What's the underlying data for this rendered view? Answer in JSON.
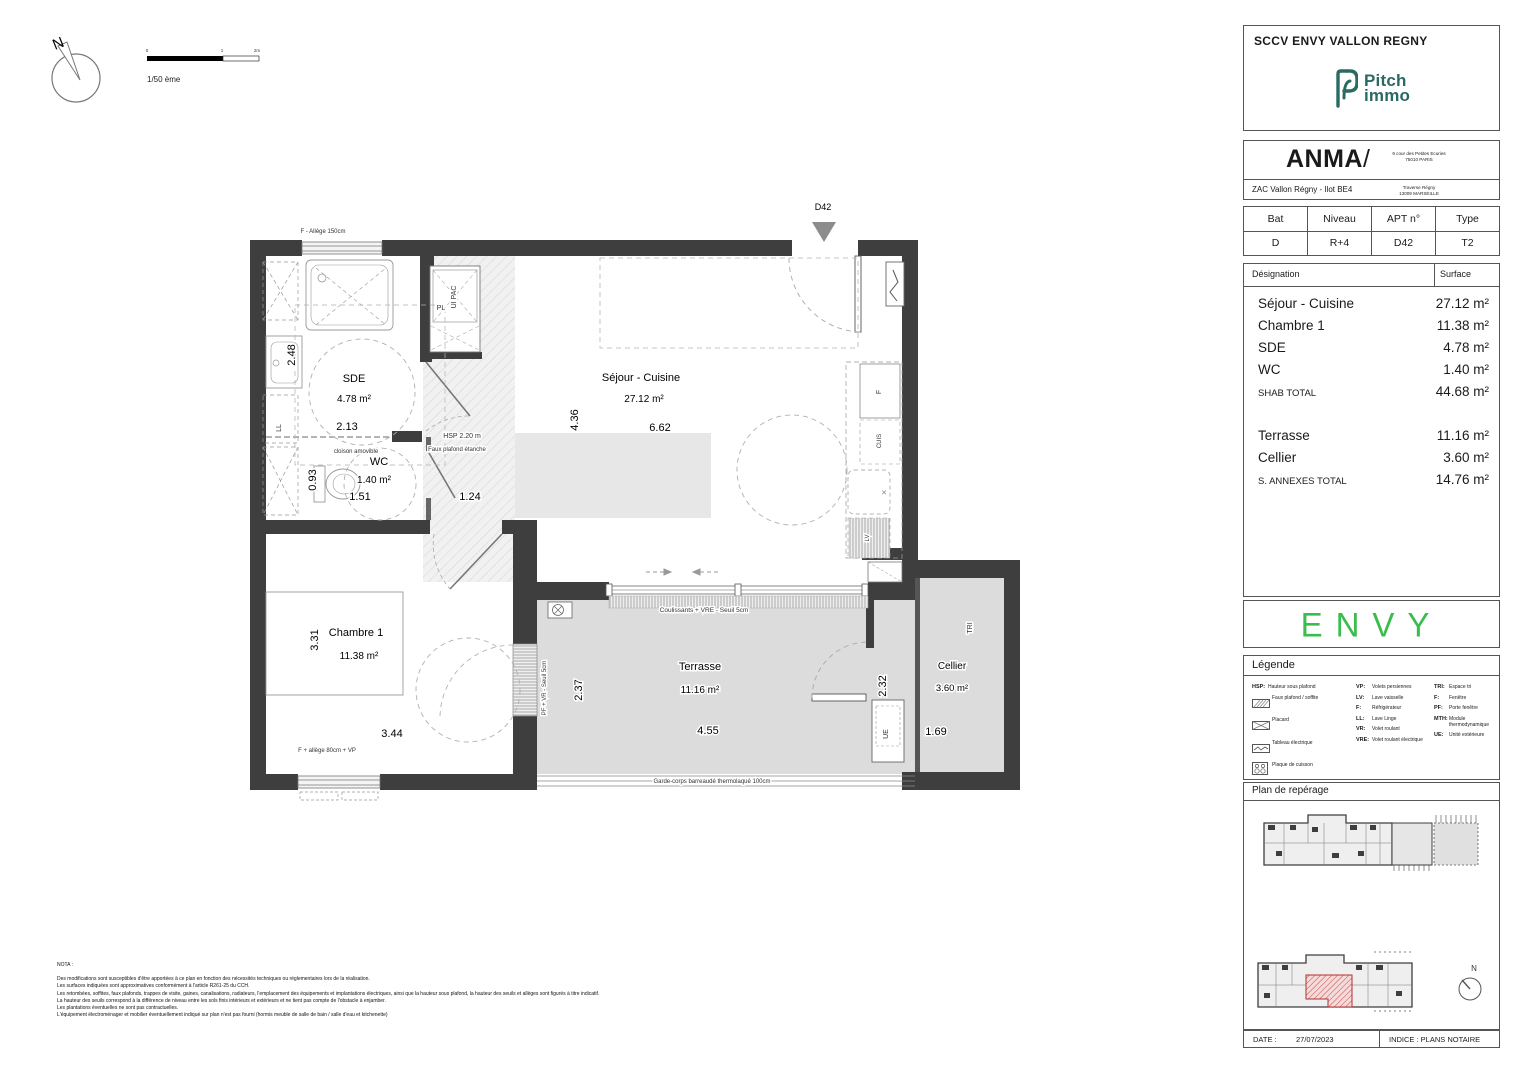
{
  "colors": {
    "wall": "#3e3e3e",
    "terrace_floor": "#dcdcdc",
    "pitch_teal": "#2b6a63",
    "envy_green": "#3bbd4d",
    "reperage_red": "#b03030"
  },
  "plan": {
    "compass_label": "N",
    "scale": {
      "text": "1/50 ème",
      "tick0": "0",
      "tick1": "1",
      "tick2": "2m"
    },
    "entrance_label": "D42",
    "rooms": {
      "sde": {
        "name": "SDE",
        "area": "4.78 m²",
        "dim_h": "2.48",
        "dim_w": "2.13"
      },
      "wc": {
        "name": "WC",
        "area": "1.40 m²",
        "dim_h": "0.93",
        "dim_w1": "1.51",
        "dim_w2": "1.24"
      },
      "sejour": {
        "name": "Séjour - Cuisine",
        "area": "27.12 m²",
        "dim_h": "4.36",
        "dim_w": "6.62"
      },
      "chambre": {
        "name": "Chambre 1",
        "area": "11.38 m²",
        "dim_h": "3.31",
        "dim_w": "3.44"
      },
      "terrasse": {
        "name": "Terrasse",
        "area": "11.16 m²",
        "dim_h": "2.37",
        "dim_w": "4.55"
      },
      "cellier": {
        "name": "Cellier",
        "area": "3.60 m²",
        "dim_h": "2.32",
        "dim_w": "1.69"
      }
    },
    "annotations": {
      "top_window": "F - Allège 150cm",
      "hsp": "HSP 2.20 m",
      "faux_plafond": "Faux plafond étanche",
      "cloison": "cloison amovible",
      "pl": "PL",
      "ui_pac": "UI PAC",
      "ll": "LL",
      "fridge": "F",
      "cuis": "CUIS",
      "lv": "LV",
      "chambre_window": "F + allège 80cm + VP",
      "terrace_sliding": "Coulissants + VRE - Seuil 5cm",
      "garde_corps": "Garde-corps barreaudé thermolaqué 100cm",
      "pf_vr": "PF + VR - Seuil 5cm",
      "tri": "TRI",
      "ue": "UE"
    }
  },
  "nota": {
    "title": "NOTA :",
    "lines": [
      "Des modifications sont susceptibles d'être apportées à ce plan en fonction des nécessités techniques ou réglementaires lors de la réalisation.",
      "Les surfaces indiquées sont approximatives conformément à l'article R261-25 du CCH.",
      "Les retombées, soffites, faux plafonds, trappes de visite, gaines, canalisations, radiateurs, l'emplacement des équipements et implantations électriques, ainsi que la hauteur sous plafond, la hauteur des seuils et allèges sont figurés à titre indicatif.",
      "La hauteur des seuils correspond à la différence de niveau entre les sols finis intérieurs et extérieurs et ne tient pas compte de l'obstacle à enjamber.",
      "Les plantations éventuelles ne sont pas contractuelles.",
      "L'équipement électroménager et mobilier éventuellement indiqué sur plan n'est pas fourni (hormis meuble de salle de bain / salle d'eau et kitchenette)"
    ]
  },
  "sidebar": {
    "developer": "SCCV ENVY VALLON REGNY",
    "pitch_logo": {
      "line1": "Pitch",
      "line2": "immo"
    },
    "architect": {
      "name": "ANMA",
      "slash": "/",
      "address1_line1": "9 cour des Petites Ecuries",
      "address1_line2": "75010 PARIS",
      "project": "ZAC Vallon Régny - Ilot BE4",
      "address2_line1": "Traverse Régny",
      "address2_line2": "13009 MARSEILLE"
    },
    "unit_table": {
      "h1": "Bat",
      "h2": "Niveau",
      "h3": "APT n°",
      "h4": "Type",
      "v1": "D",
      "v2": "R+4",
      "v3": "D42",
      "v4": "T2"
    },
    "surface_table": {
      "col1": "Désignation",
      "col2": "Surface",
      "rows": [
        {
          "label": "Séjour - Cuisine",
          "value": "27.12 m²"
        },
        {
          "label": "Chambre 1",
          "value": "11.38 m²"
        },
        {
          "label": "SDE",
          "value": "4.78 m²"
        },
        {
          "label": "WC",
          "value": "1.40 m²"
        },
        {
          "label": "SHAB TOTAL",
          "value": "44.68 m²"
        },
        {
          "label": "Terrasse",
          "value": "11.16 m²"
        },
        {
          "label": "Cellier",
          "value": "3.60 m²"
        },
        {
          "label": "S. ANNEXES TOTAL",
          "value": "14.76 m²"
        }
      ]
    },
    "brand": "ENVY",
    "legend": {
      "title": "Légende",
      "col1": [
        {
          "abbr": "HSP:",
          "label": "Hauteur sous plafond"
        },
        {
          "label": "Faux plafond / soffite"
        },
        {
          "label": "Placard"
        },
        {
          "label": "Tableau électrique"
        },
        {
          "label": "Plaque de cuisson"
        },
        {
          "label": "Gaine Technique"
        }
      ],
      "col2": [
        {
          "abbr": "VP:",
          "label": "Volets persiennes"
        },
        {
          "abbr": "LV:",
          "label": "Lave vaisselle"
        },
        {
          "abbr": "F:",
          "label": "Réfrigérateur"
        },
        {
          "abbr": "LL:",
          "label": "Lave Linge"
        },
        {
          "abbr": "VR:",
          "label": "Volet roulant"
        },
        {
          "abbr": "VRE:",
          "label": "Volet roulant électrique"
        }
      ],
      "col3": [
        {
          "abbr": "TRI:",
          "label": "Espace tri"
        },
        {
          "abbr": "F:",
          "label": "Fenêtre"
        },
        {
          "abbr": "PF:",
          "label": "Porte fenêtre"
        },
        {
          "abbr": "MTH:",
          "label": "Module thermodynamique"
        },
        {
          "abbr": "UE:",
          "label": "Unité extérieure"
        }
      ]
    },
    "reperage": {
      "title": "Plan de repérage",
      "north": "N"
    },
    "footer": {
      "date_label": "DATE :",
      "date": "27/07/2023",
      "indice": "INDICE : PLANS NOTAIRE"
    }
  }
}
